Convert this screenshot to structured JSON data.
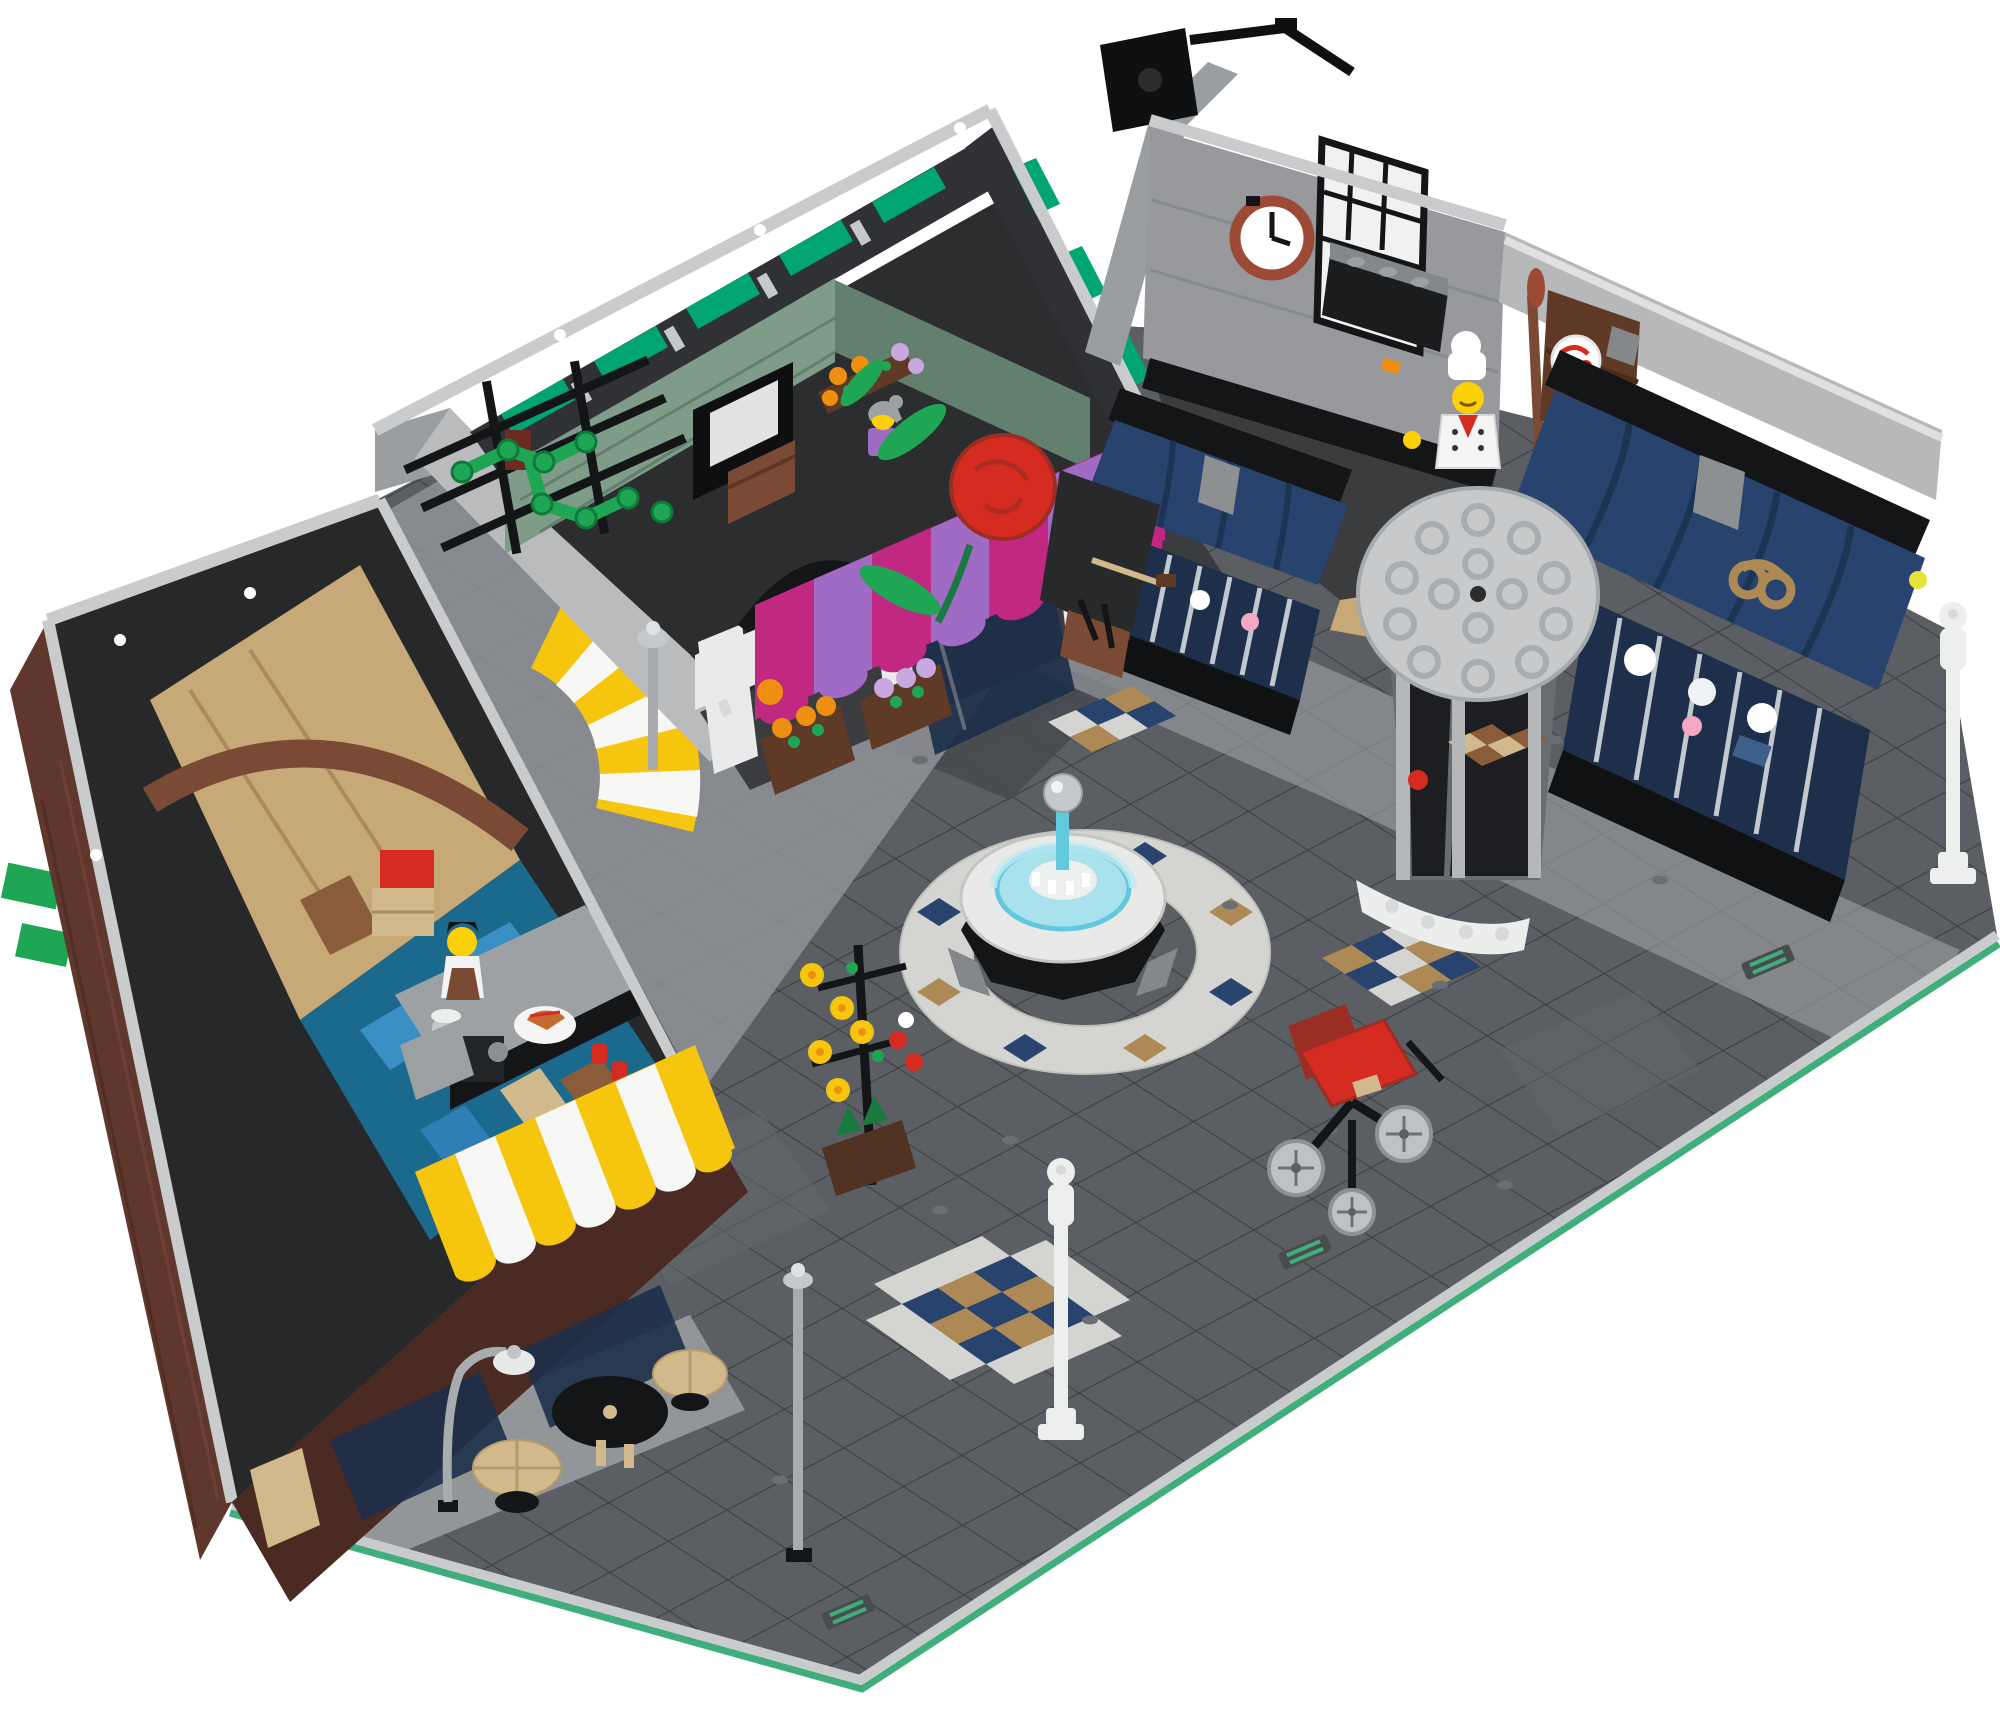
{
  "image": {
    "kind": "product photograph",
    "subject": "LEGO modular town-square building set seen from a high three-quarter angle",
    "description": "Open-top aerial view of a LEGO plaza: corner cafe with brick walls and yellow-white striped awnings, grocery and flower shop with sand-green interior and emerald clerestory windows, bakery with dark-blue bay-window awnings, pretzel sign and round grey corner-turret roof, white fountain with light-blue water dome, white and grey street lamps, black flower stand, red pram, mosaic tile patches and green baseplate edges on dark grey paving, all on a plain white background.",
    "background_color": "#ffffff",
    "visible_text": []
  },
  "palette": {
    "bg": "#ffffff",
    "plaza": "#5b5f63",
    "plaza_dark": "#46494d",
    "plaza_line": "#3f4246",
    "sidewalk": "#999c9f",
    "lane": "#8f9296",
    "mosaic_white": "#d4d5d1",
    "green_edge": "#3fae7a",
    "trim_light": "#c9cbcc",
    "trim_white": "#e9eaeb",
    "wall_mid": "#9b9ea1",
    "wall_dark": "#494c4f",
    "interior_dark": "#26282a",
    "black": "#141517",
    "glass": "#1d2f4a",
    "brick": "#5f372d",
    "brick_dark": "#4a2a22",
    "brick_line": "#73453a",
    "nougat": "#a65c33",
    "tan": "#d2b98c",
    "dark_tan": "#ad8a55",
    "tan_floor": "#c7a977",
    "brown": "#5f3a27",
    "reddish_brown": "#7a4a35",
    "red": "#d62b20",
    "dark_red": "#9a2e24",
    "rust": "#9c4a36",
    "yellow": "#f6c50e",
    "orange": "#ef8f12",
    "magenta": "#c12882",
    "med_lavender": "#a06bc4",
    "lavender": "#c9a8e0",
    "earth_blue": "#27436e",
    "earth_blue_dark": "#1c3354",
    "azure": "#3a8fc4",
    "teal_blue": "#1b6a8e",
    "sand_green": "#7e9c88",
    "sand_green_dark": "#62806d",
    "bright_green": "#1fa654",
    "dark_green": "#187a40",
    "trans_green": "#00a572",
    "silver": "#c6c9cc",
    "silver_dark": "#9da0a3",
    "trans_lblue": "#a9e2ec",
    "trans_blue": "#62c8dc",
    "lamp_white": "#edefef",
    "face_yellow": "#fcd006",
    "pink": "#f2a7c3",
    "stud": "#6b6f73"
  },
  "objects": {
    "plaza": {
      "label": "dark grey tiled plaza base with green baseplate edge and light sidewalk bands"
    },
    "cafe": {
      "label": "corner cafe: brick walls, espresso bar interior, barista minifigure, two yellow-white striped awnings, black storefront, outdoor tables"
    },
    "grocery": {
      "label": "grocery and flower shop: sand-green interior walls, emerald clerestory window strip, florist minifigure with flower racks"
    },
    "florist_front": {
      "label": "flower shop storefront: magenta and lavender striped awning, glass door, flower boxes, giant red rose sign, green espalier tree on black trellis"
    },
    "bakery": {
      "label": "bakery: white door and rust wall clock, baker minifigure with cake shelf, two dark-blue bay-window awnings with pretzel sign, grey round corner-turret roof, black camera rig on the roof edge"
    },
    "fountain": {
      "label": "white round fountain with light-blue water dome, chrome sphere and mosaic surround"
    },
    "pram": {
      "label": "red baby pram with grey spoked wheels"
    },
    "flower_stand": {
      "label": "black flower stand with yellow and red blooms"
    },
    "lamps": {
      "label": "two white street lamps and three grey cafe lamps"
    },
    "mosaics": {
      "label": "white, dark-blue and tan mosaic tile patches"
    },
    "minifigures": {
      "barista": "barista minifigure with black hair and apron holding a pie",
      "florist": "grey-haired florist minifigure among flowers",
      "baker": "baker minifigure with white chef hat and red neckerchief"
    }
  }
}
